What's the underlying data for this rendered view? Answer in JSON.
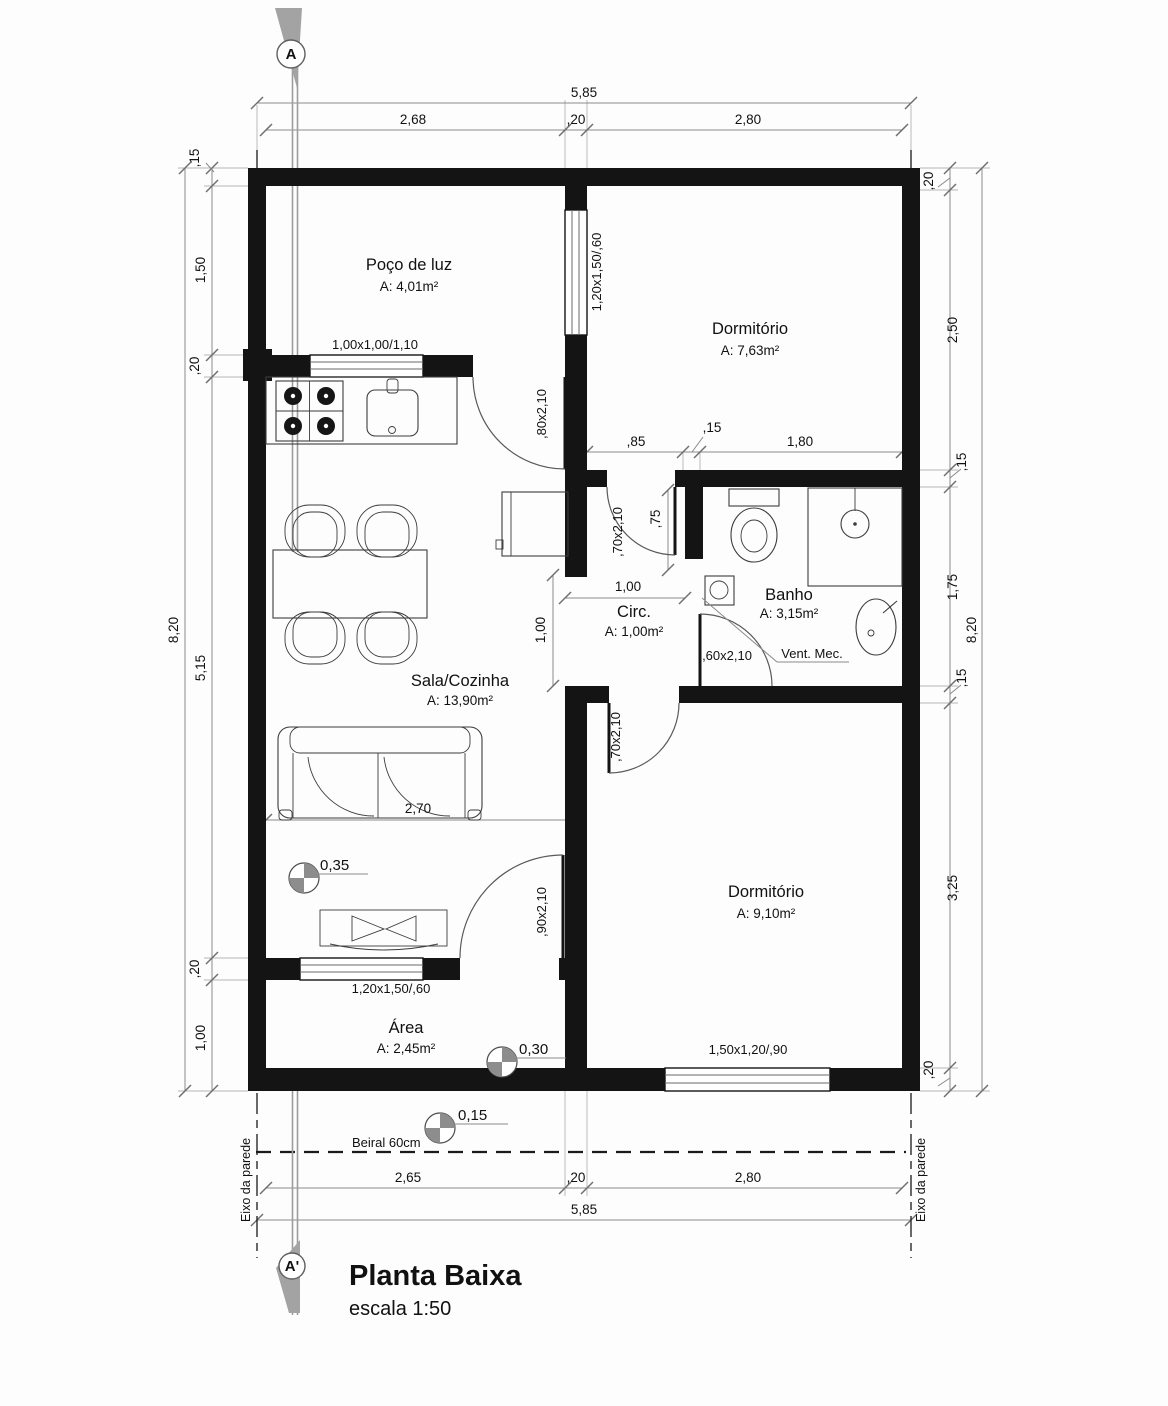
{
  "title": {
    "name": "Planta Baixa",
    "scale": "escala 1:50"
  },
  "section_markers": {
    "top": "A",
    "bottom": "A'"
  },
  "rooms": {
    "poco": {
      "name": "Poço de luz",
      "area": "A: 4,01m²"
    },
    "dorm1": {
      "name": "Dormitório",
      "area": "A: 7,63m²"
    },
    "banho": {
      "name": "Banho",
      "area": "A: 3,15m²"
    },
    "circ": {
      "name": "Circ.",
      "area": "A: 1,00m²"
    },
    "sala": {
      "name": "Sala/Cozinha",
      "area": "A: 13,90m²"
    },
    "servico": {
      "name": "Área",
      "area": "A: 2,45m²"
    },
    "dorm2": {
      "name": "Dormitório",
      "area": "A: 9,10m²"
    }
  },
  "dims": {
    "top_total": "5,85",
    "top_chain": [
      "2,68",
      ",20",
      "2,80"
    ],
    "bottom_chain": [
      "2,65",
      ",20",
      "2,80"
    ],
    "bottom_total": "5,85",
    "left_total": "8,20",
    "left_chain": [
      ",15",
      "1,50",
      ",20",
      "5,15",
      ",20",
      "1,00"
    ],
    "right_total": "8,20",
    "right_chain": [
      ",20",
      "2,50",
      ",15",
      "1,75",
      ",15",
      "3,25",
      ",20"
    ],
    "banho_chain": [
      ",85",
      ",15",
      "1,80"
    ],
    "sala_width": "2,70",
    "circ_w": "1,00",
    "circ_h": "1,00",
    "door_swing": ",75"
  },
  "openings": {
    "kitchen_window": "1,00x1,00/1,10",
    "poco_dorm_window": "1,20x1,50/,60",
    "area_window": "1,20x1,50/,60",
    "dorm2_window": "1,50x1,20/,90",
    "kitchen_door": ",80x2,10",
    "dorm1_door": ",70x2,10",
    "banho_door": ",60x2,10",
    "dorm2_door": ",70x2,10",
    "area_door": ",90x2,10"
  },
  "levels": {
    "sala": "0,35",
    "servico": "0,30",
    "exterior": "0,15"
  },
  "annotations": {
    "vent": "Vent. Mec.",
    "beiral": "Beiral 60cm",
    "eixo_left": "Eixo da parede",
    "eixo_right": "Eixo da parede"
  }
}
